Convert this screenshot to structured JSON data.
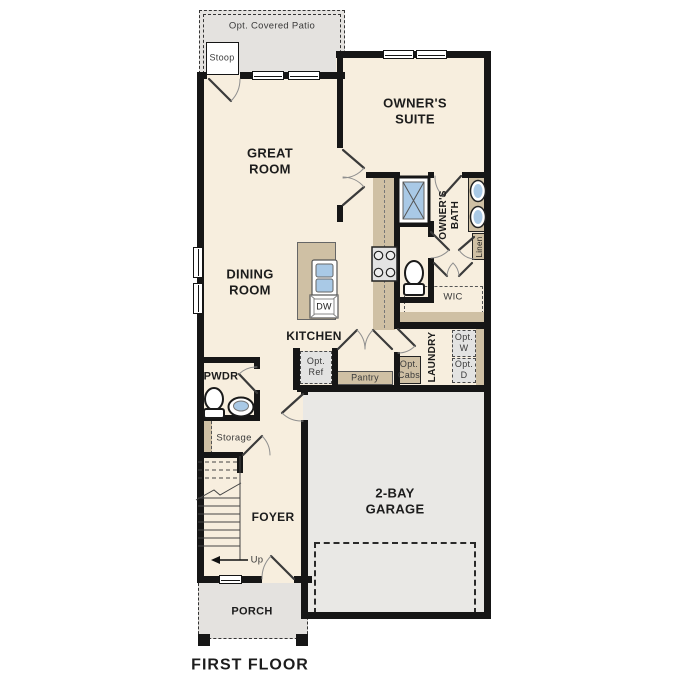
{
  "title": "FIRST FLOOR",
  "colors": {
    "floor": "#f7eede",
    "patio_porch": "#e4e2df",
    "garage_floor": "#e9e8e5",
    "cabinet_tan": "#cfc0a4",
    "fixture_blue": "#a9c9e6",
    "wall": "#161616"
  },
  "labels": {
    "patio": "Opt. Covered Patio",
    "stoop": "Stoop",
    "great_room": "GREAT\nROOM",
    "owners_suite": "OWNER'S\nSUITE",
    "owners_bath": "OWNER'S\nBATH",
    "linen": "Linen",
    "wic": "WIC",
    "dining_room": "DINING\nROOM",
    "kitchen": "KITCHEN",
    "dw": "DW",
    "opt_ref": "Opt.\nRef",
    "pantry": "Pantry",
    "opt_cabs": "Opt.\nCabs",
    "laundry": "LAUNDRY",
    "opt_w": "Opt.\nW",
    "opt_d": "Opt.\nD",
    "pwdr": "PWDR",
    "storage": "Storage",
    "foyer": "FOYER",
    "up": "Up",
    "garage": "2-BAY\nGARAGE",
    "porch": "PORCH",
    "first_floor": "FIRST FLOOR"
  }
}
